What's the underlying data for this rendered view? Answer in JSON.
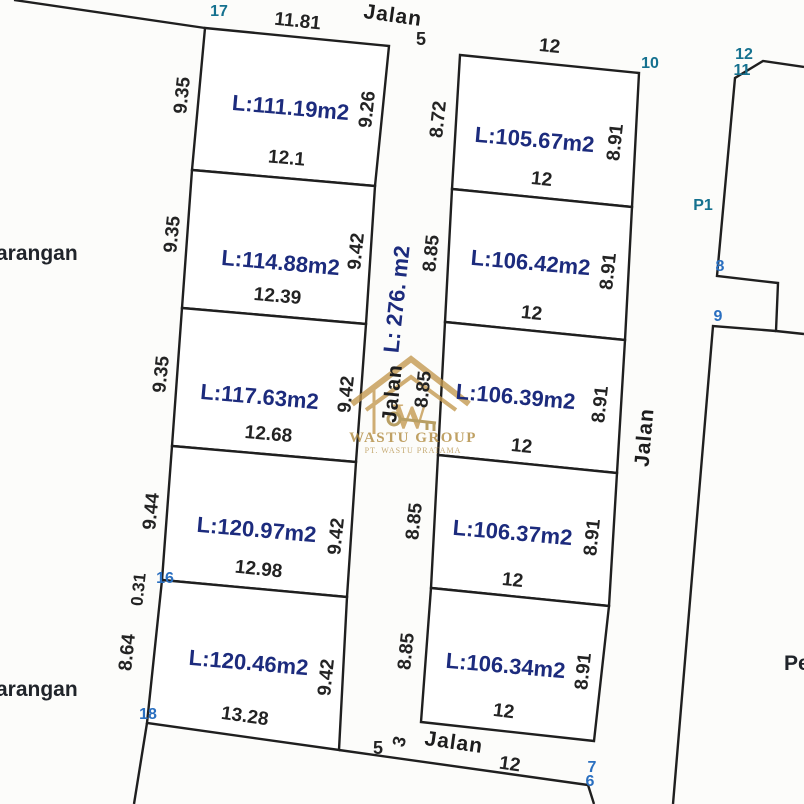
{
  "document": {
    "type": "land-subdivision-site-plan",
    "colors": {
      "line": "#1f1f1f",
      "area_text": "#1c2b7d",
      "point_teal": "#15718f",
      "point_blue": "#2a6fc0",
      "watermark_gold": "#c49a52",
      "paper": "#fcfcfa"
    }
  },
  "left_plots": [
    {
      "area": "L:111.19m2",
      "top": "11.81",
      "left": "9.35",
      "right": "9.26",
      "bottom": "12.1"
    },
    {
      "area": "L:114.88m2",
      "left": "9.35",
      "right": "9.42",
      "bottom": "12.39"
    },
    {
      "area": "L:117.63m2",
      "left": "9.35",
      "right": "9.42",
      "bottom": "12.68"
    },
    {
      "area": "L:120.97m2",
      "left": "9.44",
      "left_extra": "0.31",
      "right": "9.42",
      "bottom": "12.98"
    },
    {
      "area": "L:120.46m2",
      "left": "8.64",
      "right": "9.42",
      "bottom": "13.28"
    }
  ],
  "right_plots": [
    {
      "area": "L:105.67m2",
      "top": "12",
      "left": "8.72",
      "right": "8.91",
      "bottom": "12"
    },
    {
      "area": "L:106.42m2",
      "left": "8.85",
      "right": "8.91",
      "bottom": "12"
    },
    {
      "area": "L:106.39m2",
      "left": "8.85",
      "right": "8.91",
      "bottom": "12"
    },
    {
      "area": "L:106.37m2",
      "left": "8.85",
      "right": "8.91",
      "bottom": "12"
    },
    {
      "area": "L:106.34m2",
      "left": "8.85",
      "right": "8.91",
      "bottom": "12"
    }
  ],
  "roads": {
    "top_label": "Jalan",
    "center_label": "Jalan",
    "center_area": "L: 276. m2",
    "right_label": "Jalan",
    "bottom_label": "Jalan",
    "bottom_width": "12"
  },
  "survey_points": {
    "pt17": "17",
    "pt16": "16",
    "pt18": "18",
    "pt10": "10",
    "pt12": "12",
    "pt11": "11",
    "pt8": "8",
    "pt9": "9",
    "pt7": "7",
    "pt6": "6",
    "pt5_top": "5",
    "pt5_bottom": "5",
    "pt3": "3",
    "pt_p1": "P1"
  },
  "edge_labels": {
    "left_upper": "arangan",
    "left_lower": "arangan",
    "right_partial": "Pe"
  },
  "watermark": {
    "monogram": "W",
    "brand": "WASTU GROUP",
    "subline": "PT. WASTU PRATAMA"
  }
}
